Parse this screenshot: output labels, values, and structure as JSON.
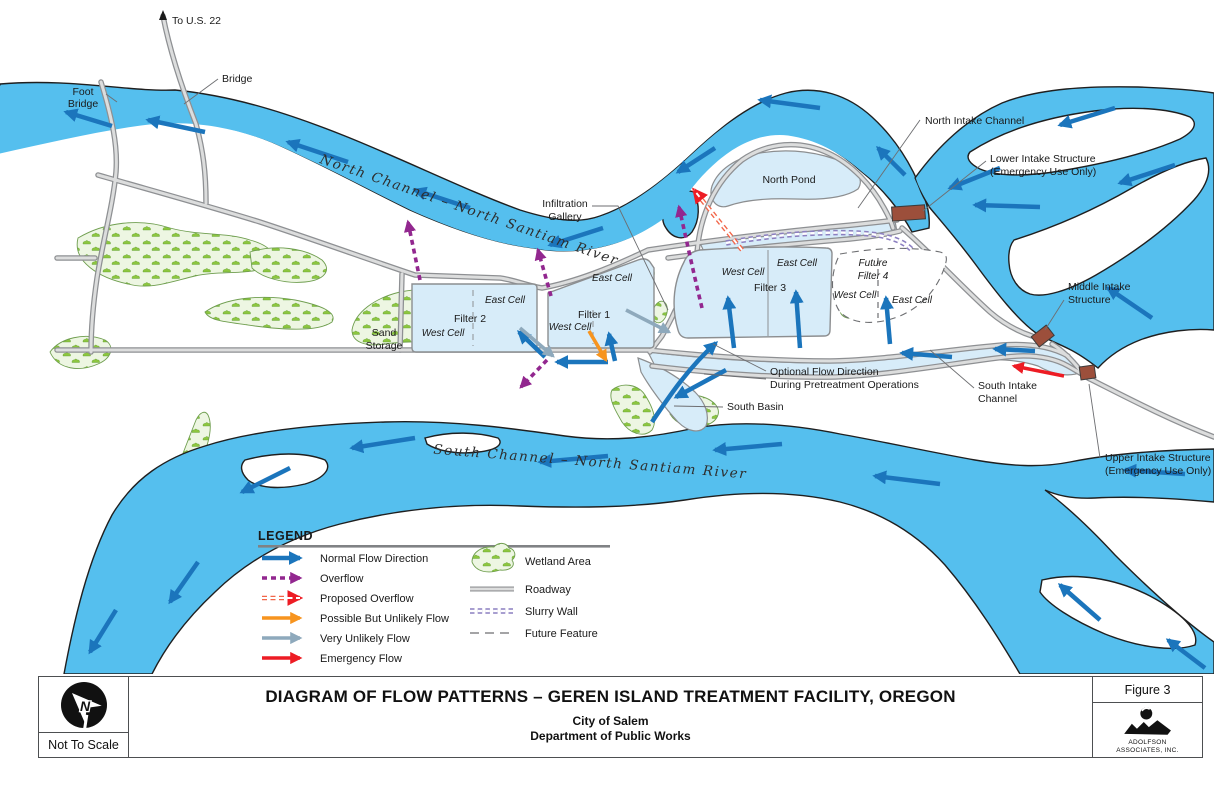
{
  "map": {
    "labels": {
      "to_us22": "To U.S. 22",
      "bridge": "Bridge",
      "foot_bridge_line1": "Foot",
      "foot_bridge_line2": "Bridge",
      "north_channel": "North Channel – North Santiam River",
      "south_channel": "South Channel – North Santiam River",
      "infiltration_line1": "Infiltration",
      "infiltration_line2": "Gallery",
      "north_pond": "North Pond",
      "north_intake_channel": "North Intake Channel",
      "lower_intake_line1": "Lower Intake Structure",
      "lower_intake_line2": "(Emergency Use Only)",
      "middle_intake_line1": "Middle Intake",
      "middle_intake_line2": "Structure",
      "upper_intake_line1": "Upper Intake Structure",
      "upper_intake_line2": "(Emergency Use Only)",
      "south_intake_line1": "South Intake",
      "south_intake_line2": "Channel",
      "sand_storage_line1": "Sand",
      "sand_storage_line2": "Storage",
      "filter1": "Filter 1",
      "filter2": "Filter 2",
      "filter3": "Filter 3",
      "future_filter_line1": "Future",
      "future_filter_line2": "Filter 4",
      "east_cell": "East Cell",
      "west_cell": "West Cell",
      "south_basin": "South Basin",
      "optional_flow_line1": "Optional Flow Direction",
      "optional_flow_line2": "During Pretreatment Operations"
    }
  },
  "legend": {
    "title": "LEGEND",
    "flow": [
      {
        "label": "Normal Flow Direction",
        "color": "#1b75bc",
        "style": "solid"
      },
      {
        "label": "Overflow",
        "color": "#92278f",
        "style": "dashed"
      },
      {
        "label": "Proposed Overflow",
        "color": "#f26649",
        "style": "double-dashed"
      },
      {
        "label": "Possible But Unlikely Flow",
        "color": "#f7941e",
        "style": "solid"
      },
      {
        "label": "Very Unlikely Flow",
        "color": "#8ea9bc",
        "style": "solid"
      },
      {
        "label": "Emergency Flow",
        "color": "#ed1c24",
        "style": "solid"
      }
    ],
    "symbols": [
      {
        "label": "Wetland Area"
      },
      {
        "label": "Roadway"
      },
      {
        "label": "Slurry Wall"
      },
      {
        "label": "Future Feature"
      }
    ]
  },
  "title_block": {
    "scale_note": "Not To Scale",
    "title": "DIAGRAM OF FLOW PATTERNS – GEREN ISLAND TREATMENT FACILITY, OREGON",
    "subtitle_line1": "City of Salem",
    "subtitle_line2": "Department of Public Works",
    "figure_label": "Figure 3",
    "firm_line1": "ADOLFSON",
    "firm_line2": "ASSOCIATES, INC."
  },
  "colors": {
    "river": "#55bfee",
    "shallow_water": "#d7ecf9",
    "wetland": "#edf6e2",
    "road_fill": "#dcdddd",
    "road_casing": "#8e9093",
    "normal_flow": "#1b75bc",
    "overflow": "#92278f",
    "proposed_overflow": "#f26649",
    "possible_flow": "#f7941e",
    "very_unlikely_flow": "#8ea9bc",
    "emergency_flow": "#ed1c24",
    "intake_structure": "#9c4f3b",
    "slurry_wall": "#8b7fc0"
  }
}
